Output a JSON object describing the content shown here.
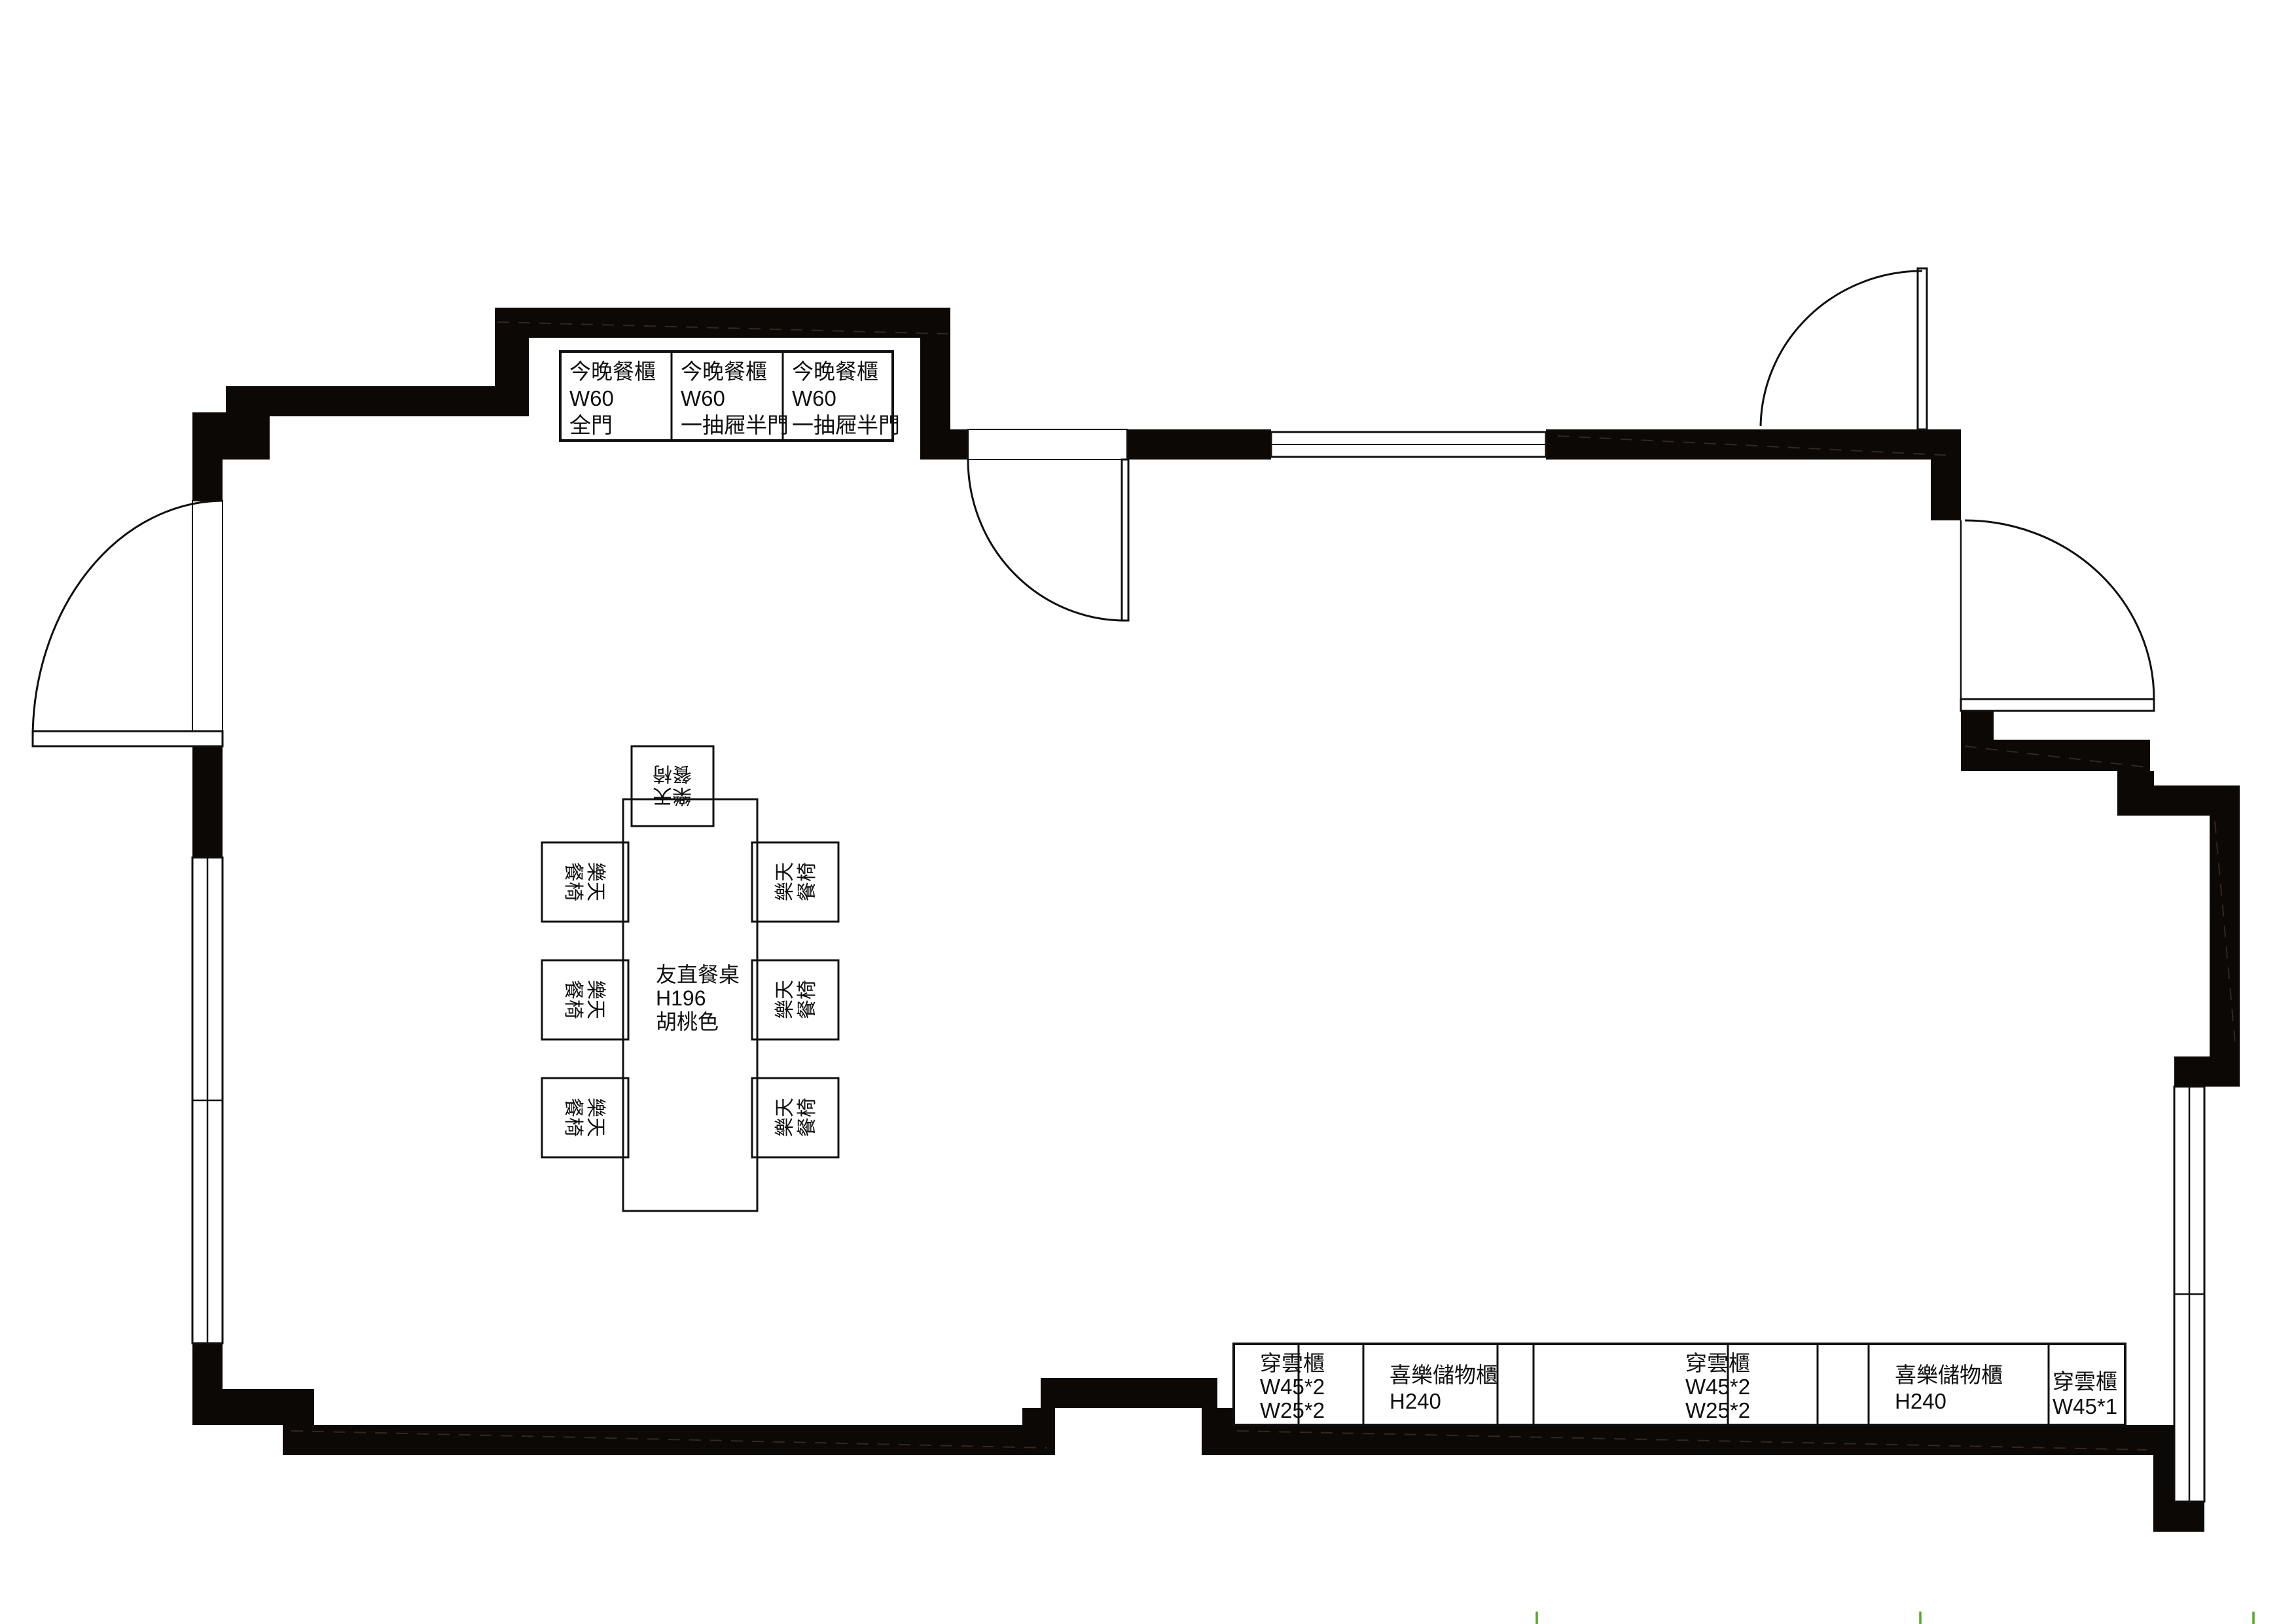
{
  "plan": {
    "title": "dining-room-floor-plan",
    "colors": {
      "background": "#FFFFFF",
      "wall": "#0C0806",
      "line": "#101010",
      "hatch": "#3A2B21",
      "tick_green": "#56A82A"
    },
    "cabinets_top": {
      "items": [
        {
          "lines": [
            "今晚餐櫃",
            "W60",
            "全門"
          ]
        },
        {
          "lines": [
            "今晚餐櫃",
            "W60",
            "一抽屜半門"
          ]
        },
        {
          "lines": [
            "今晚餐櫃",
            "W60",
            "一抽屜半門"
          ]
        }
      ]
    },
    "cabinets_bottom": {
      "cells": [
        {
          "lines": [
            "穿雲櫃",
            "W45*2",
            "W25*2"
          ]
        },
        {
          "lines": [
            "喜樂儲物櫃",
            "H240"
          ]
        },
        {
          "lines": [
            "穿雲櫃",
            "W45*2",
            "W25*2"
          ]
        },
        {
          "lines": [
            "喜樂儲物櫃",
            "H240"
          ]
        },
        {
          "lines": [
            "穿雲櫃",
            "W45*1"
          ]
        }
      ]
    },
    "dining": {
      "table_lines": [
        "友直餐桌",
        "H196",
        "胡桃色"
      ],
      "chair_line1": "樂天",
      "chair_line2": "餐椅",
      "chair_count": 7
    }
  }
}
